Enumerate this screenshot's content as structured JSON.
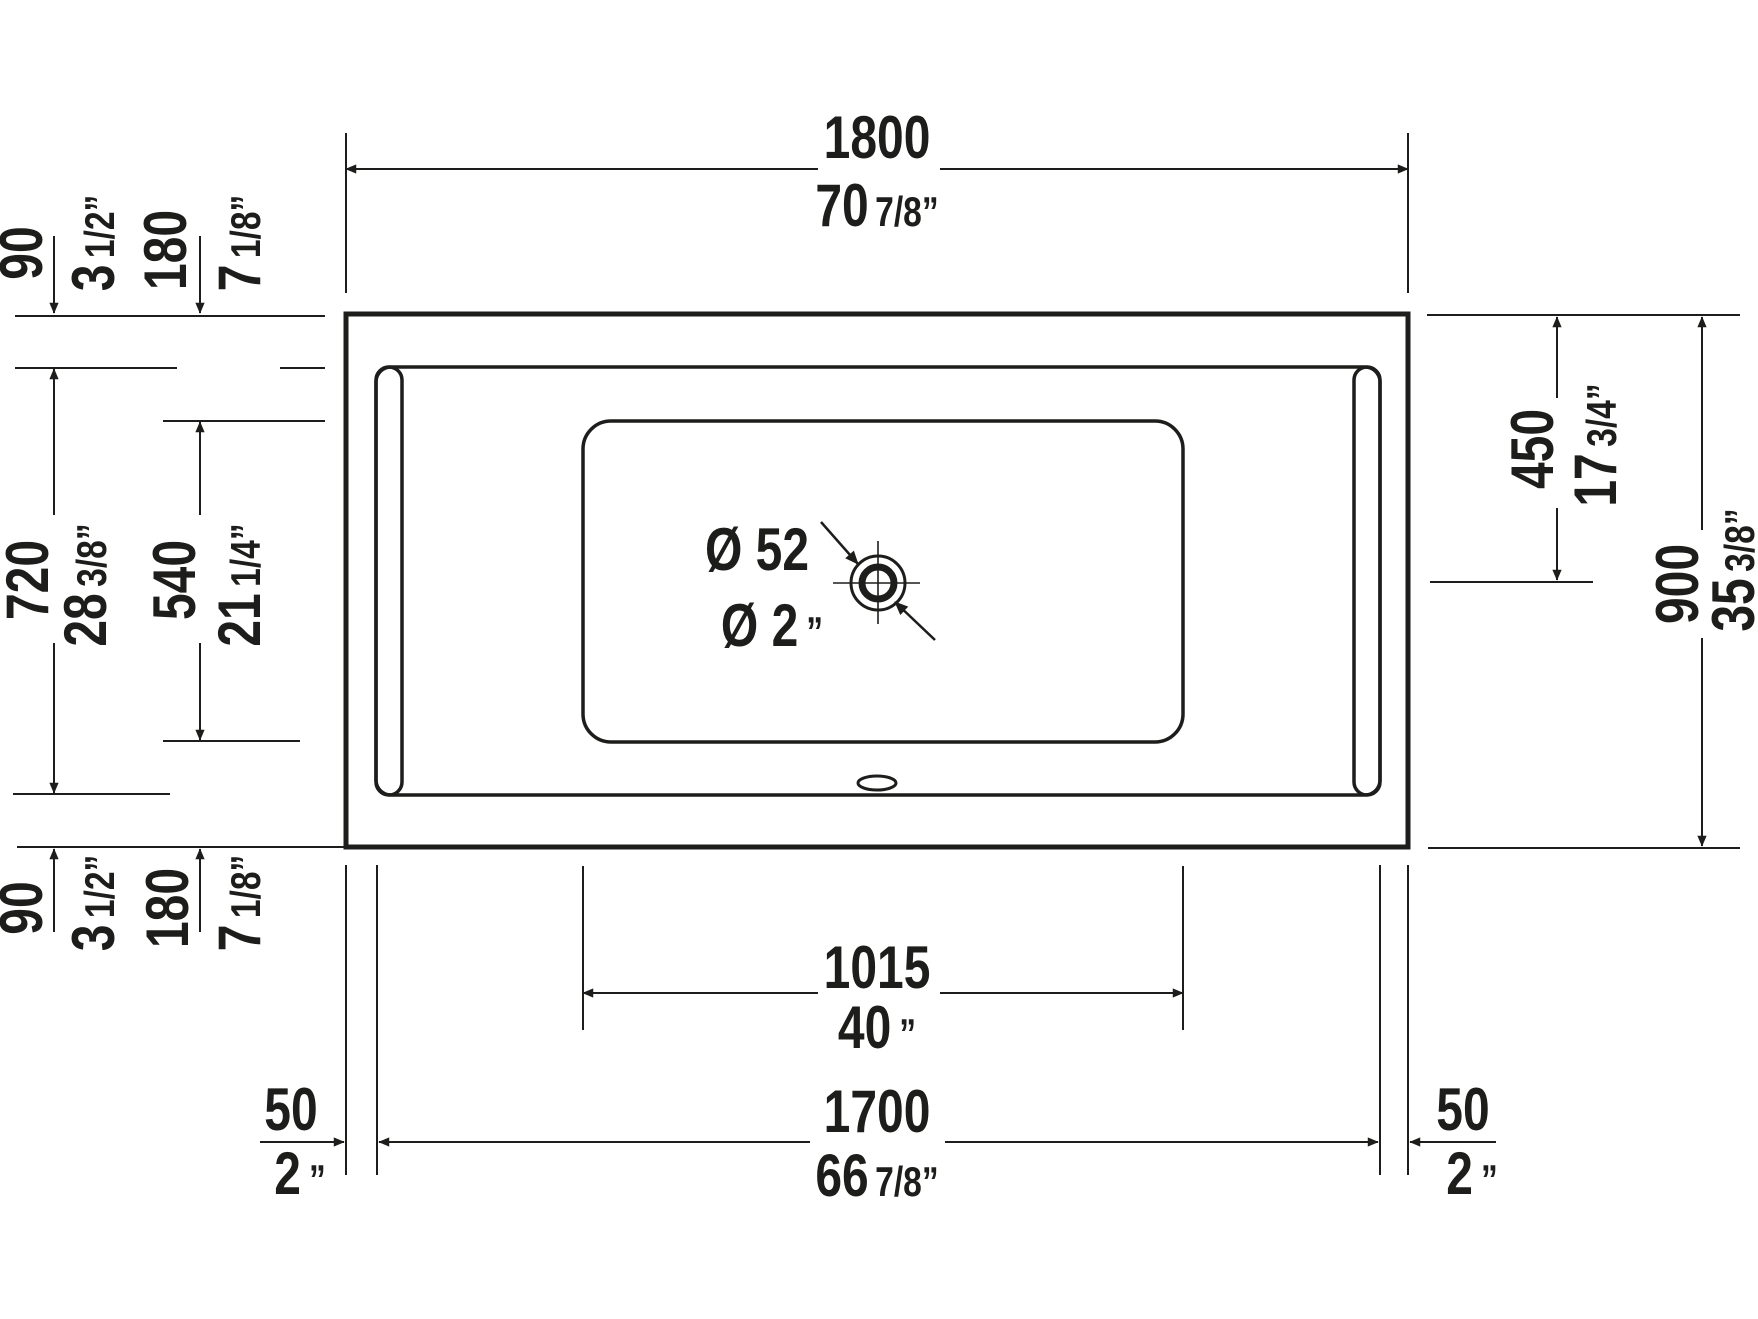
{
  "drawing": {
    "type": "bathtub-top-view-technical-drawing",
    "units": "mm over inches",
    "line_color": "#1d1d1b",
    "background_color": "#ffffff"
  },
  "dims": {
    "outer_length": {
      "mm": "1800",
      "in_main": "70",
      "in_frac": "7/8”"
    },
    "outer_width": {
      "mm": "900",
      "in_main": "35",
      "in_frac": "3/8”"
    },
    "deck_small": {
      "mm": "90",
      "in_main": "3",
      "in_frac": "1/2”"
    },
    "deck_large": {
      "mm": "180",
      "in_main": "7",
      "in_frac": "1/8”"
    },
    "inner_width": {
      "mm": "720",
      "in_main": "28",
      "in_frac": "3/8”"
    },
    "floor_width": {
      "mm": "540",
      "in_main": "21",
      "in_frac": "1/4”"
    },
    "drain_offset": {
      "mm": "450",
      "in_main": "17",
      "in_frac": "3/4”"
    },
    "floor_length": {
      "mm": "1015",
      "in_main": "40",
      "in_frac": "”"
    },
    "inner_length": {
      "mm": "1700",
      "in_main": "66",
      "in_frac": "7/8”"
    },
    "side_deck": {
      "mm": "50",
      "in_main": "2",
      "in_frac": "”"
    },
    "drain_diameter": {
      "metric": "Ø 52",
      "in_main": "Ø 2",
      "in_frac": "”"
    }
  }
}
